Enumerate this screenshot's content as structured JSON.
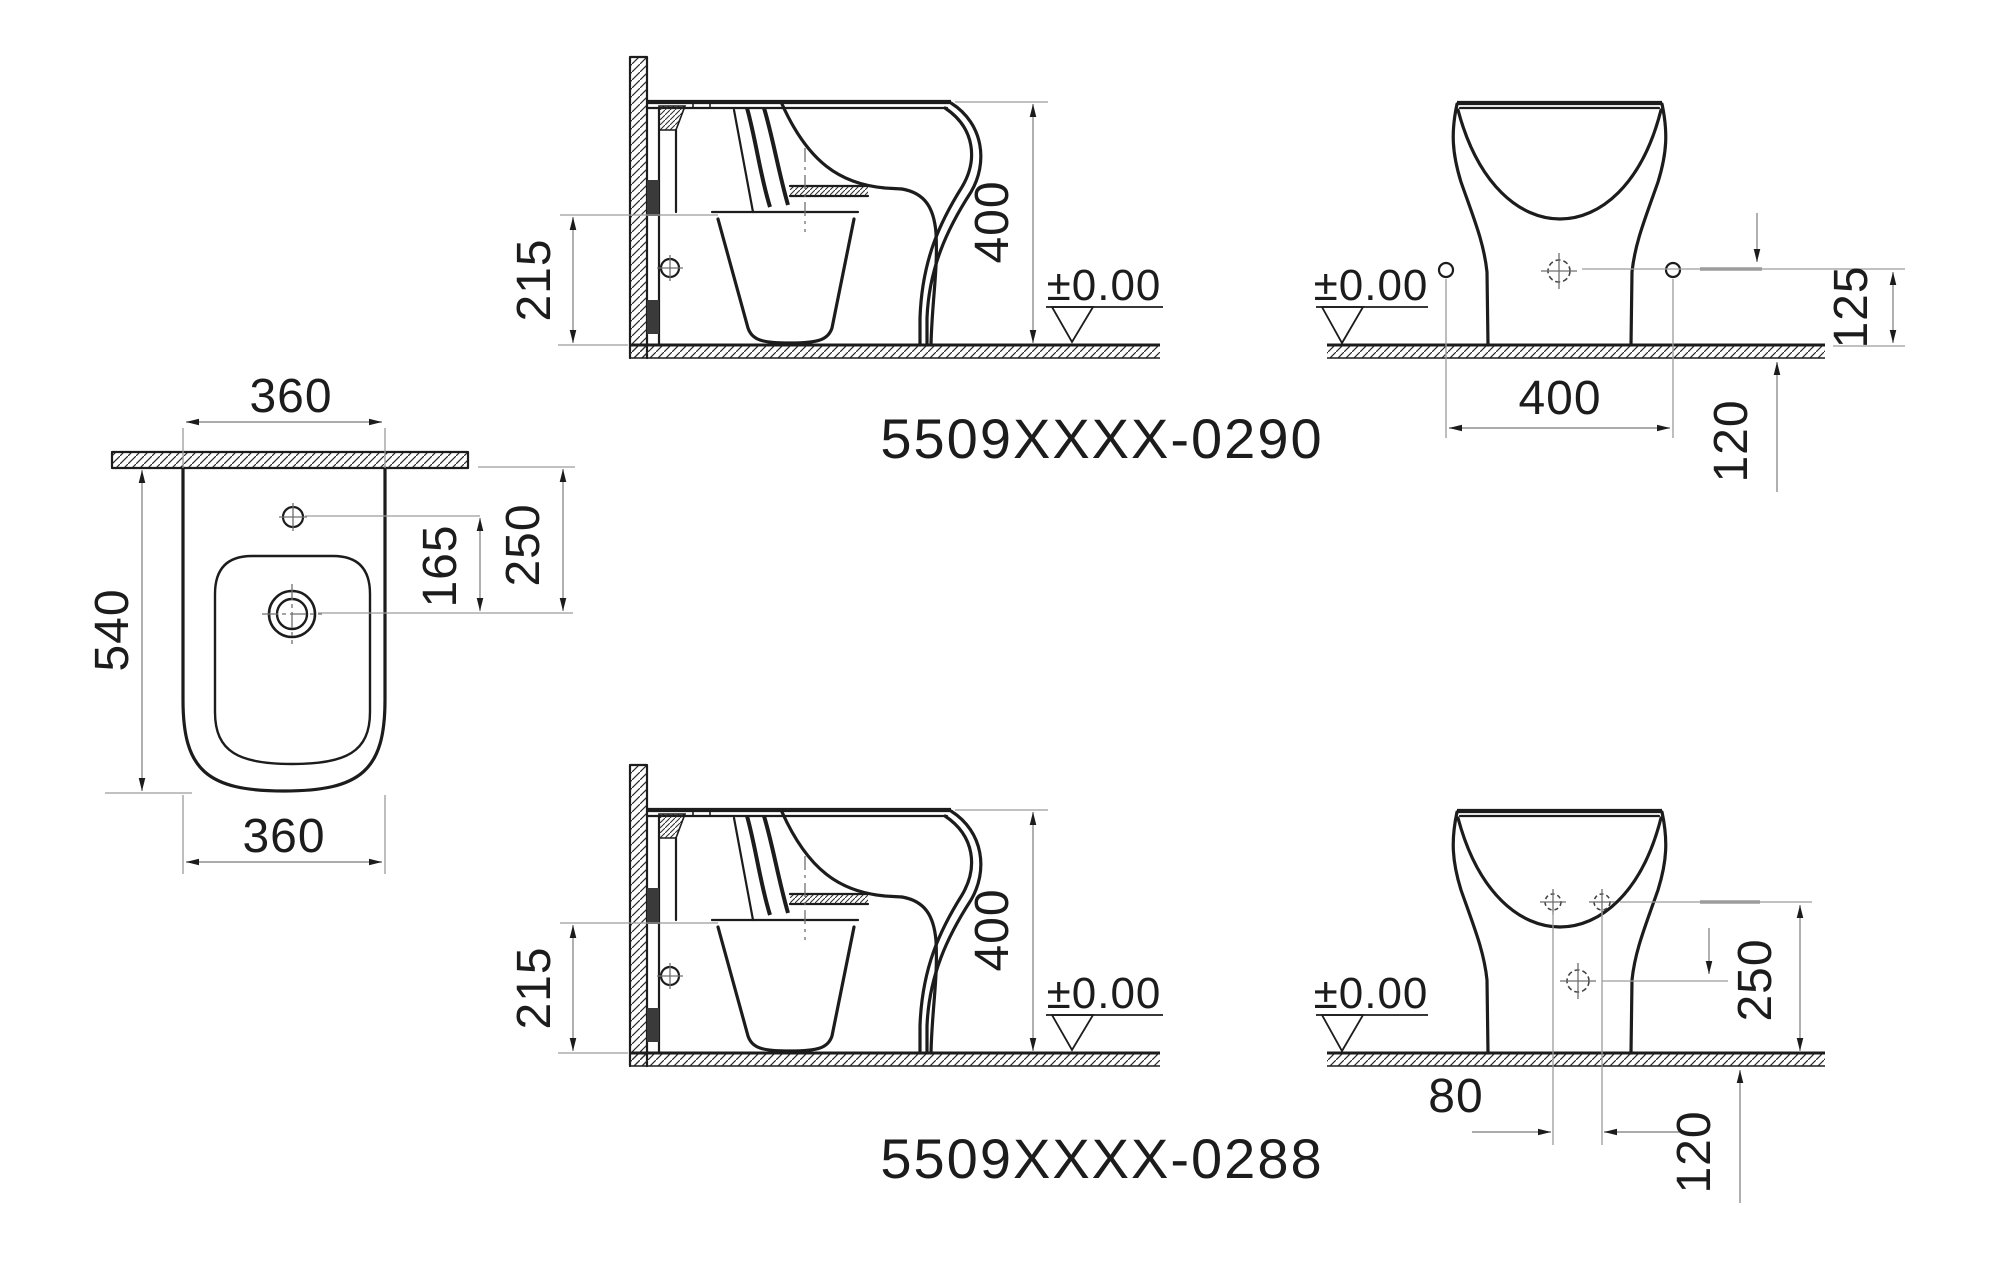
{
  "document_type": "sanitary-ware installation drawing",
  "colors": {
    "ink": "#1c1c1c",
    "dim_line": "#8f8f8f",
    "background": "#ffffff"
  },
  "product_codes": {
    "variant_0290": "5509XXXX-0290",
    "variant_0288": "5509XXXX-0288"
  },
  "plan_view": {
    "width_top": "360",
    "depth": "540",
    "hole_to_drain": "165",
    "wall_to_drain": "250",
    "width_bottom": "360"
  },
  "side_section_0290": {
    "bowl_height": "215",
    "total_height": "400",
    "floor_datum": "±0.00"
  },
  "front_view_0290": {
    "floor_datum": "±0.00",
    "side_hole_spacing": "400",
    "side_hole_height": "125",
    "outlet_offset": "120"
  },
  "side_section_0288": {
    "bowl_height": "215",
    "total_height": "400",
    "floor_datum": "±0.00"
  },
  "front_view_0288": {
    "floor_datum": "±0.00",
    "top_hole_spacing": "80",
    "top_hole_height": "250",
    "outlet_offset": "120"
  }
}
